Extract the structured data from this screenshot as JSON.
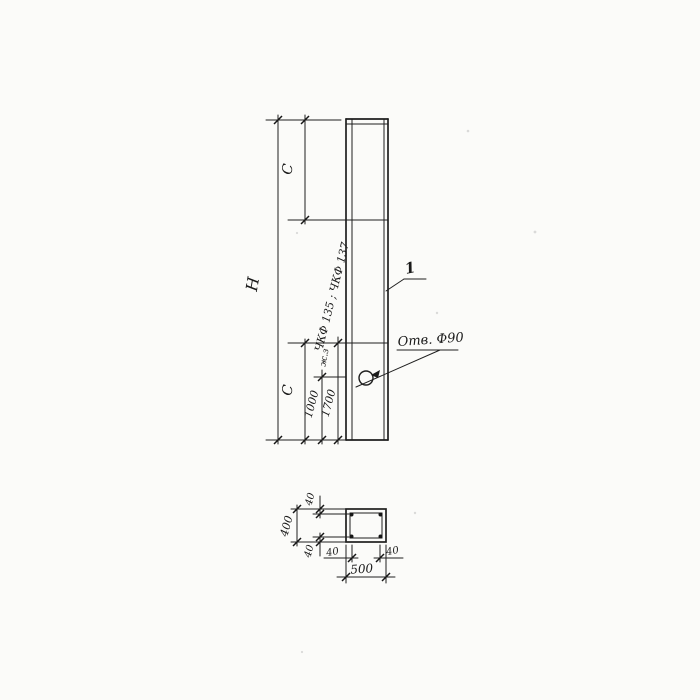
{
  "drawing": {
    "kind": "scanned engineering drawing - reinforced concrete post, elevation and cross-section",
    "line_color": "#1f1f1f",
    "background_color": "#fbfbf9",
    "view_elevation": {
      "overall_height_label": "H",
      "top_segment_label": "C",
      "bottom_segment_label": "C",
      "hole_offset_dim": "1000",
      "upper_offset_dim": "1700",
      "small_note": "ж.з",
      "series_note": "ЧКФ 135 ; ЧКФ 137",
      "hole_callout": "Отв. Ф90",
      "part_number": "1"
    },
    "view_section": {
      "overall_width_dim": "500",
      "overall_height_dim": "400",
      "cover_top_dim": "40",
      "cover_bottom_dim": "40",
      "cover_left_dim": "40",
      "cover_right_dim": "40"
    }
  }
}
